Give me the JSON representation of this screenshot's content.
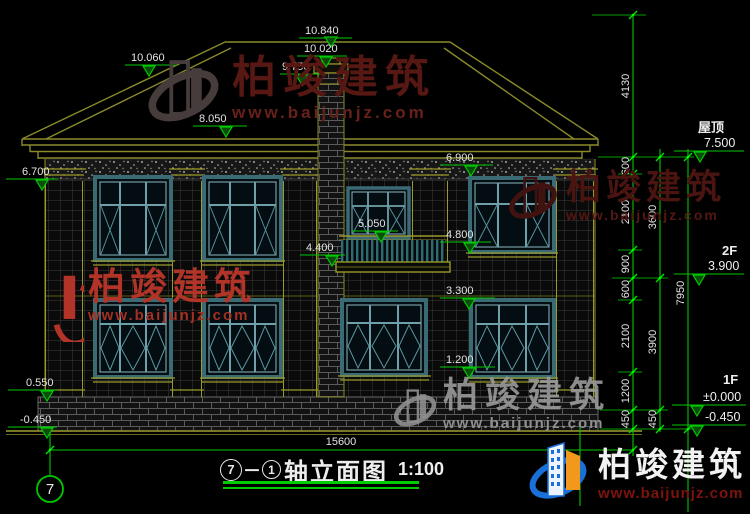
{
  "drawing": {
    "title": {
      "axis_start": "7",
      "separator": "－",
      "axis_end": "1",
      "name": "轴立面图",
      "scale": "1:100"
    },
    "axis_bubble": "7",
    "elevations": {
      "ridge": "10.840",
      "hip_left": "10.060",
      "chimney_top": "10.020",
      "chimney_neck": "9.750",
      "eave_top": "8.050",
      "eave_left": "6.700",
      "eave_right": "6.900",
      "balcony_window_sill": "5.050",
      "f2_window_sill": "4.800",
      "balcony_floor": "4.400",
      "f1_window_head": "3.300",
      "f1_window_sill": "1.200",
      "plinth_top": "0.550",
      "ground_left": "-0.450"
    },
    "levels": {
      "roof_label": "屋顶",
      "roof_value": "7.500",
      "f2_label": "2F",
      "f2_value": "3.900",
      "f1_label": "1F",
      "f1_value": "±0.000",
      "f1_value_below": "-0.450"
    },
    "dim_chain_inner": [
      "4130",
      "600",
      "2100",
      "900",
      "600",
      "2100",
      "1200",
      "450"
    ],
    "dim_chain_mid": [
      "3600",
      "3900",
      "450"
    ],
    "dim_total": "7950",
    "dim_width": "15600"
  },
  "watermarks": {
    "brand": "柏竣建筑",
    "url": "www.baijunjz.com"
  },
  "logo": {
    "brand": "柏竣建筑",
    "url": "www.baijunjz.com"
  },
  "colors": {
    "dimension_green": "#00c800",
    "line_olive": "#8a8a2a",
    "window_teal": "#6fa0aa",
    "logo_blue": "#1a6fd8",
    "logo_orange": "#f2991d"
  }
}
